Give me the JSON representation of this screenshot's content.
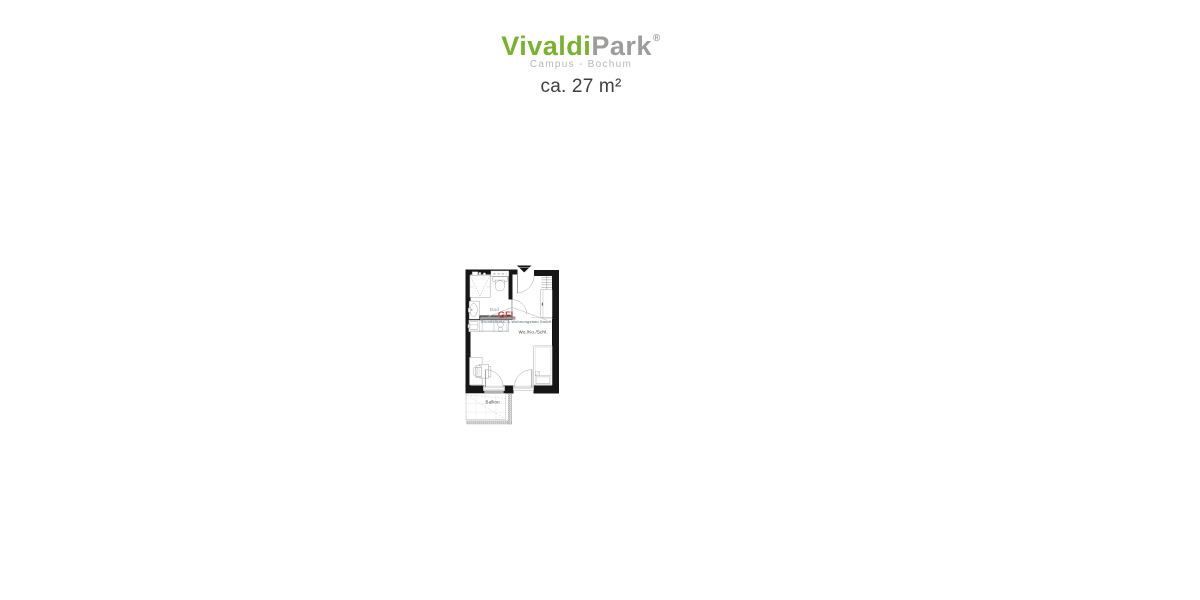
{
  "brand": {
    "part_green": "Vivaldi",
    "part_gray": "Park",
    "registered": "®",
    "subtitle": "Campus - Bochum",
    "color_green": "#77b32c",
    "color_gray": "#9d9d9c"
  },
  "area": {
    "label": "ca. 27 m²"
  },
  "floorplan": {
    "room_labels": {
      "bath": "Bad",
      "living": "Wo./Ko./Schl.",
      "balcony": "Balkon"
    },
    "watermark": {
      "logo": "GFI",
      "company": "Grundstücks- & Wohnungsbau GmbH",
      "logo_color": "#c24a4a",
      "company_color": "#868d96"
    },
    "wall_color": "#161616",
    "icons": {
      "entrance_marker": "triangle-down"
    }
  }
}
